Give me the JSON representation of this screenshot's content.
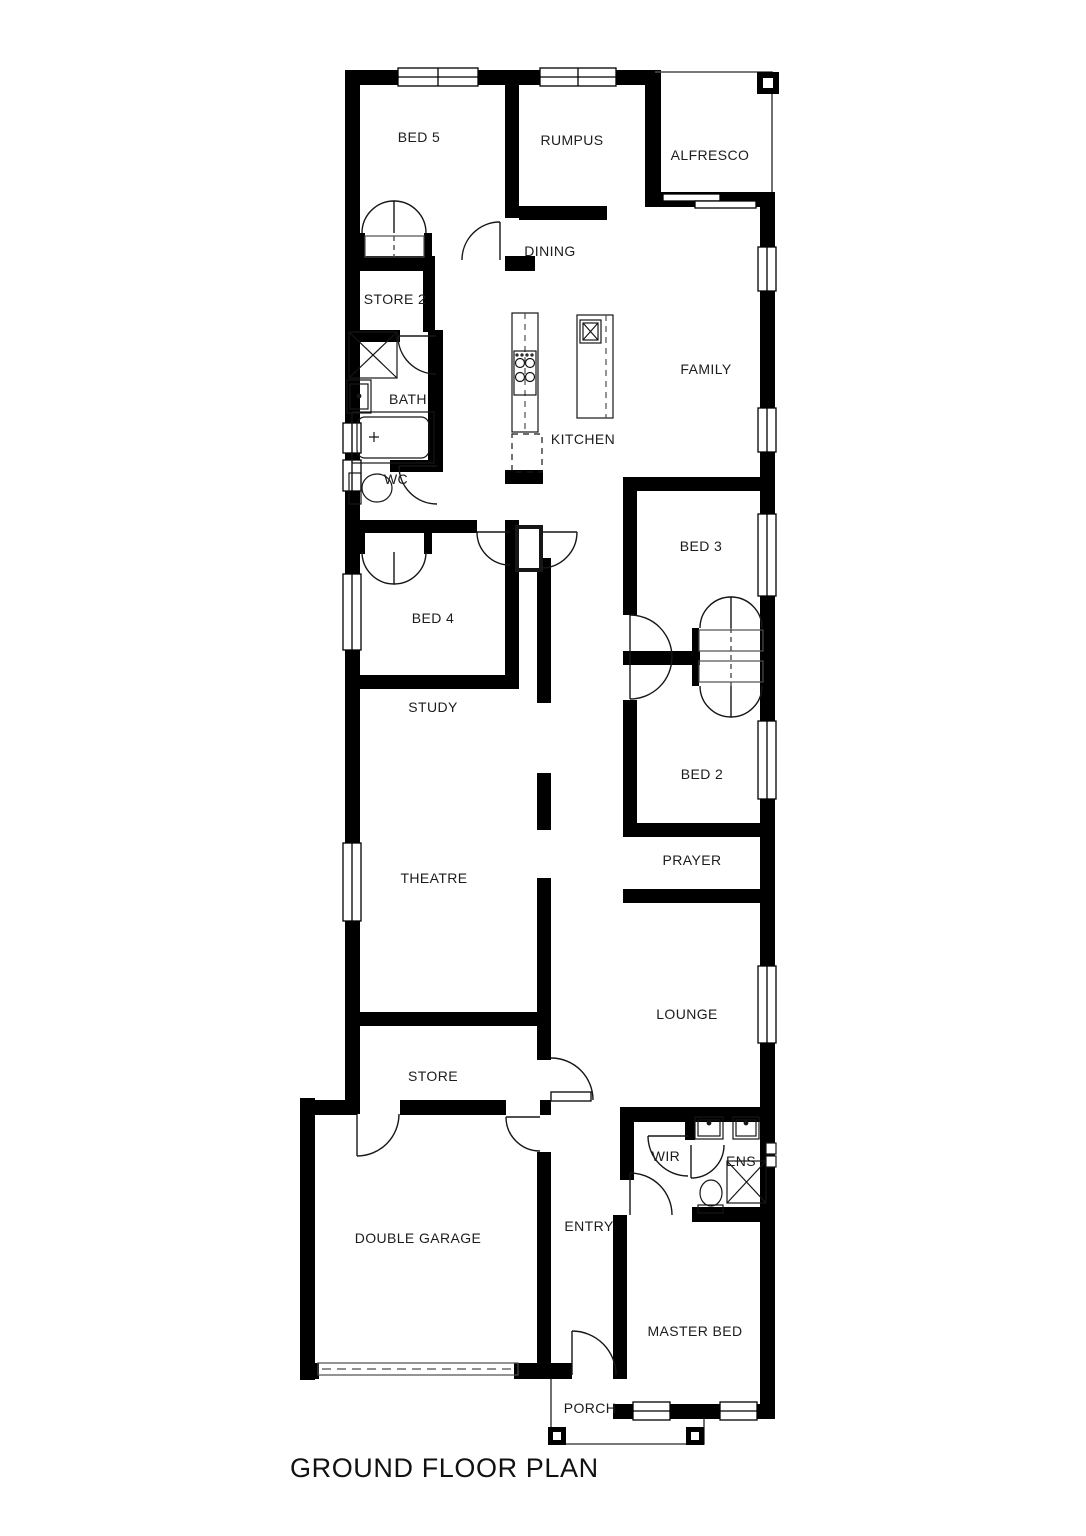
{
  "title": "GROUND FLOOR PLAN",
  "colors": {
    "wall": "#000000",
    "thin_line": "#4d4d4d",
    "background": "#ffffff",
    "text": "#1c1c1c"
  },
  "rooms": [
    {
      "id": "bed5",
      "label": "BED 5"
    },
    {
      "id": "rumpus",
      "label": "RUMPUS"
    },
    {
      "id": "alfresco",
      "label": "ALFRESCO"
    },
    {
      "id": "dining",
      "label": "DINING"
    },
    {
      "id": "store2",
      "label": "STORE 2"
    },
    {
      "id": "bath",
      "label": "BATH"
    },
    {
      "id": "kitchen",
      "label": "KITCHEN"
    },
    {
      "id": "family",
      "label": "FAMILY"
    },
    {
      "id": "wc",
      "label": "WC"
    },
    {
      "id": "bed3",
      "label": "BED 3"
    },
    {
      "id": "bed4",
      "label": "BED 4"
    },
    {
      "id": "study",
      "label": "STUDY"
    },
    {
      "id": "bed2",
      "label": "BED 2"
    },
    {
      "id": "theatre",
      "label": "THEATRE"
    },
    {
      "id": "prayer",
      "label": "PRAYER"
    },
    {
      "id": "lounge",
      "label": "LOUNGE"
    },
    {
      "id": "store",
      "label": "STORE"
    },
    {
      "id": "double-garage",
      "label": "DOUBLE GARAGE"
    },
    {
      "id": "entry",
      "label": "ENTRY"
    },
    {
      "id": "wir",
      "label": "WIR"
    },
    {
      "id": "ens",
      "label": "ENS"
    },
    {
      "id": "master-bed",
      "label": "MASTER BED"
    },
    {
      "id": "porch",
      "label": "PORCH"
    }
  ],
  "fixtures": [
    "shower",
    "vanity-basin",
    "bathtub",
    "toilet",
    "cooktop",
    "pantry",
    "island-bench",
    "kitchen-sink",
    "ensuite-double-basin",
    "ensuite-shower",
    "ensuite-toilet",
    "garage-panel-door",
    "sliding-door",
    "robe-bifold-doors",
    "linen-cupboard",
    "windows",
    "hinged-doors",
    "porch-posts"
  ]
}
